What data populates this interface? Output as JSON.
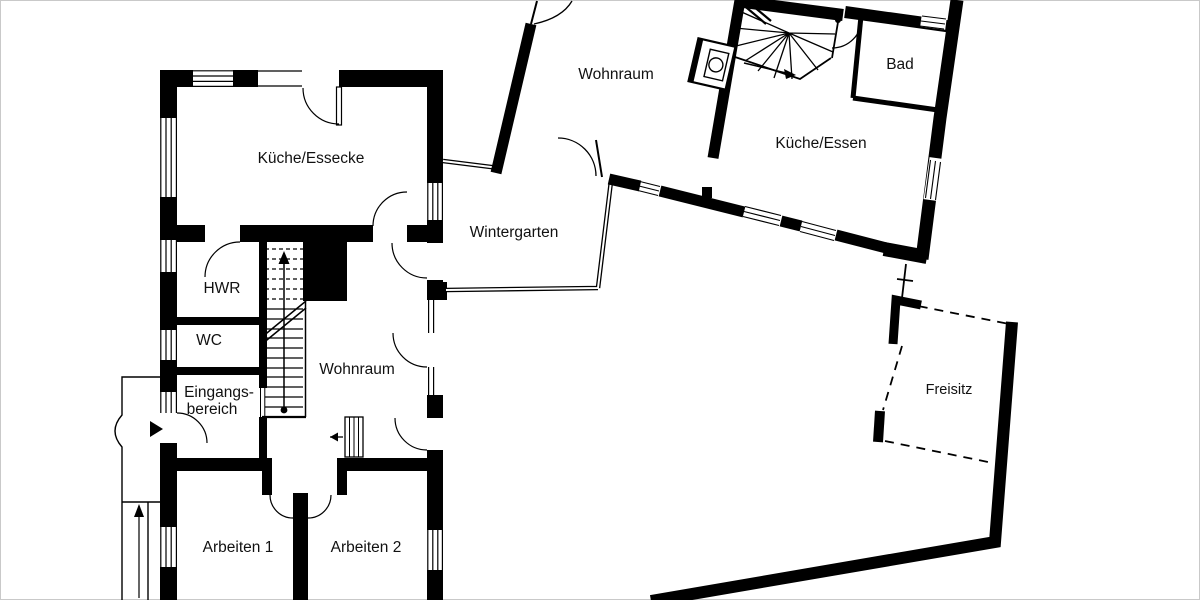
{
  "plan": {
    "kind": "floor-plan",
    "wall_color": "#000000",
    "floor_color": "#ffffff",
    "border_color": "#c9c9c9",
    "terrace_outline_style": "dashed"
  },
  "rooms": {
    "kueche_essecke": {
      "label": "Küche/Essecke"
    },
    "wohnraum_upper": {
      "label": "Wohnraum"
    },
    "bad": {
      "label": "Bad"
    },
    "kueche_essen": {
      "label": "Küche/Essen"
    },
    "wintergarten": {
      "label": "Wintergarten"
    },
    "hwr": {
      "label": "HWR"
    },
    "wc": {
      "label": "WC"
    },
    "eingangsbereich": {
      "label_line1": "Eingangs-",
      "label_line2": "bereich"
    },
    "wohnraum_lower": {
      "label": "Wohnraum"
    },
    "arbeiten1": {
      "label": "Arbeiten 1"
    },
    "arbeiten2": {
      "label": "Arbeiten 2"
    },
    "freisitz": {
      "label": "Freisitz"
    }
  },
  "symbols": {
    "main_staircase": "straight-stair-with-up-arrow",
    "spiral_staircase": "winder-stair-with-arrow",
    "fireplace": "stove-kamin-symbol",
    "entrance_marker": "black-triangle-entry-arrow",
    "walkway": "path-with-up-arrow",
    "windows": "striped-window-symbols",
    "doors": "quarter-circle-swing-arcs"
  }
}
